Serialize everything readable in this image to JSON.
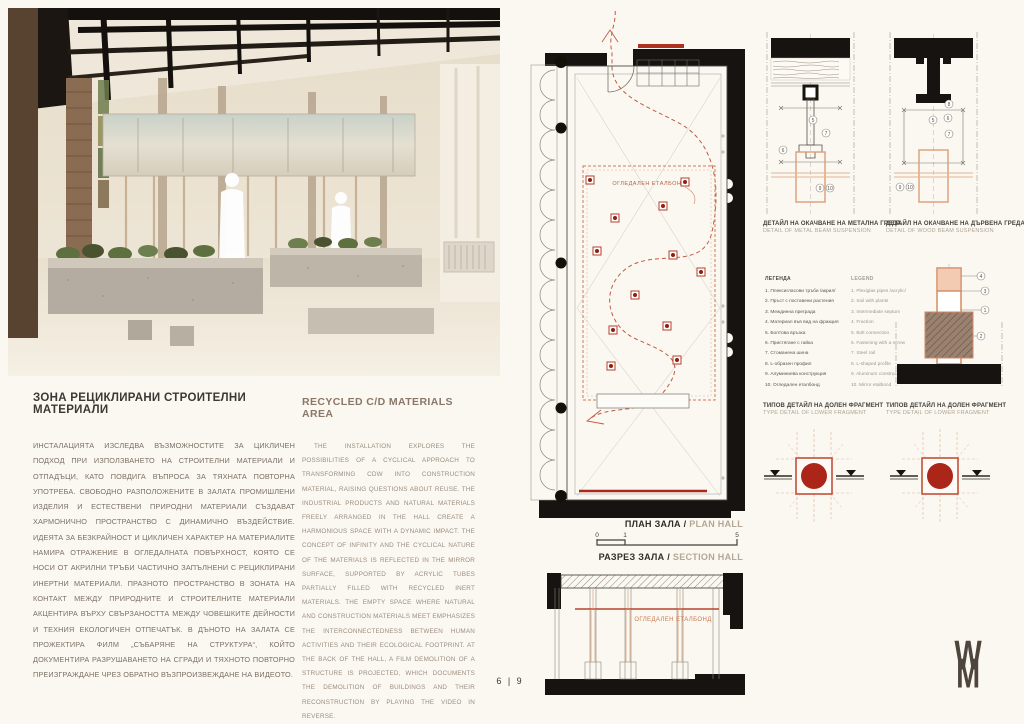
{
  "board": {
    "page_number": "6 | 9"
  },
  "colors": {
    "background": "#fbf8f2",
    "wall_black": "#171310",
    "accent_red": "#ab2619",
    "path_red": "#c25a43",
    "tube_orange": "#d6936c",
    "title_dark": "#3c3835",
    "title_brown": "#8a7767"
  },
  "left_text": {
    "bg_title": "ЗОНА РЕЦИКЛИРАНИ СТРОИТЕЛНИ МАТЕРИАЛИ",
    "bg_body": "ИНСТАЛАЦИЯТА ИЗСЛЕДВА ВЪЗМОЖНОСТИТЕ ЗА ЦИКЛИЧЕН ПОДХОД ПРИ ИЗПОЛЗВАНЕТО НА СТРОИТЕЛНИ МАТЕРИАЛИ И ОТПАДЪЦИ, КАТО ПОВДИГА ВЪПРОСА ЗА ТЯХНАТА ПОВТОРНА УПОТРЕБА. СВОБОДНО РАЗПОЛОЖЕНИТЕ В ЗАЛАТА ПРОМИШЛЕНИ ИЗДЕЛИЯ И ЕСТЕСТВЕНИ ПРИРОДНИ МАТЕРИАЛИ СЪЗДАВАТ ХАРМОНИЧНО ПРОСТРАНСТВО С ДИНАМИЧНО ВЪЗДЕЙСТВИЕ. ИДЕЯТА ЗА БЕЗКРАЙНОСТ И ЦИКЛИЧЕН ХАРАКТЕР НА МАТЕРИАЛИТЕ НАМИРА ОТРАЖЕНИЕ В ОГЛЕДАЛНАТА ПОВЪРХНОСТ, КОЯТО СЕ НОСИ ОТ АКРИЛНИ ТРЪБИ ЧАСТИЧНО ЗАПЪЛНЕНИ С РЕЦИКЛИРАНИ ИНЕРТНИ МАТЕРИАЛИ. ПРАЗНОТО ПРОСТРАНСТВО В ЗОНАТА НА КОНТАКТ МЕЖДУ ПРИРОДНИТЕ И СТРОИТЕЛНИТЕ МАТЕРИАЛИ АКЦЕНТИРА ВЪРХУ СВЪРЗАНОСТТА МЕЖДУ ЧОВЕШКИТЕ ДЕЙНОСТИ И ТЕХНИЯ ЕКОЛОГИЧЕН ОТПЕЧАТЪК. В ДЪНОТО НА ЗАЛАТА СЕ ПРОЖЕКТИРА ФИЛМ „СЪБАРЯНЕ НА СТРУКТУРА“, КОЙТО ДОКУМЕНТИРА РАЗРУШАВАНЕТО НА СГРАДИ И ТЯХНОТО ПОВТОРНО ПРЕИЗГРАЖДАНЕ ЧРЕЗ ОБРАТНО ВЪЗПРОИЗВЕЖДАНЕ НА ВИДЕОТО.",
    "en_title": "RECYCLED C/D MATERIALS AREA",
    "en_body": "THE INSTALLATION EXPLORES THE POSSIBILITIES OF A CYCLICAL APPROACH TO TRANSFORMING CDW INTO CONSTRUCTION MATERIAL, RAISING QUESTIONS ABOUT REUSE. THE INDUSTRIAL PRODUCTS AND NATURAL MATERIALS FREELY ARRANGED IN THE HALL CREATE A HARMONIOUS SPACE WITH A DYNAMIC IMPACT. THE CONCEPT OF INFINITY AND THE CYCLICAL NATURE OF THE MATERIALS IS REFLECTED IN THE MIRROR SURFACE, SUPPORTED BY ACRYLIC TUBES PARTIALLY FILLED WITH RECYCLED INERT MATERIALS. THE EMPTY SPACE WHERE NATURAL AND CONSTRUCTION MATERIALS MEET EMPHASIZES THE INTERCONNECTEDNESS BETWEEN HUMAN ACTIVITIES AND THEIR ECOLOGICAL FOOTPRINT. AT THE BACK OF THE HALL, A FILM DEMOLITION OF A STRUCTURE IS PROJECTED, WHICH DOCUMENTS THE DEMOLITION OF BUILDINGS AND THEIR RECONSTRUCTION BY PLAYING THE VIDEO IN REVERSE."
  },
  "plan": {
    "title_bg": "ПЛАН ЗАЛА",
    "sep": "/",
    "title_en": "PLAN HALL",
    "mirror_label": "ОГЛЕДАЛЕН ЕТАЛБОНД",
    "scale_ticks": [
      "0",
      "1",
      "5"
    ]
  },
  "section": {
    "title_bg": "РАЗРЕЗ ЗАЛА",
    "sep": "/",
    "title_en": "SECTION HALL",
    "mirror_label": "ОГЛЕДАЛЕН ЕТАЛБОНД"
  },
  "details": {
    "metal": {
      "title_bg": "ДЕТАЙЛ НА ОКАЧВАНЕ НА МЕТАЛНА ГРЕДА",
      "title_en": "DETAIL OF METAL BEAM SUSPENSION",
      "callouts": [
        "5",
        "6",
        "7",
        "9",
        "10"
      ]
    },
    "wood": {
      "title_bg": "ДЕТАЙЛ НА ОКАЧВАНЕ НА ДЪРВЕНА ГРЕДА",
      "title_en": "DETAIL OF WOOD BEAM SUSPENSION",
      "callouts": [
        "8",
        "5",
        "6",
        "7",
        "9",
        "10"
      ]
    },
    "base": {
      "callouts": [
        "4",
        "3",
        "1",
        "2"
      ]
    },
    "lower_left": {
      "title_bg": "ТИПОВ ДЕТАЙЛ НА ДОЛЕН ФРАГМЕНТ",
      "title_en": "TYPE DETAIL OF LOWER FRAGMENT"
    },
    "lower_right": {
      "title_bg": "ТИПОВ ДЕТАЙЛ НА ДОЛЕН ФРАГМЕНТ",
      "title_en": "TYPE DETAIL OF LOWER FRAGMENT"
    }
  },
  "legend_bg": {
    "title": "ЛЕГЕНДА",
    "items": [
      "1. Плексигласови тръби /акрил/",
      "2. Пръст с поставени растения",
      "3. Междинна преграда",
      "4. Материал във вид на фракция",
      "5. Болтова връзка",
      "6. Пристягане с гайка",
      "7. Стоманена шина",
      "8. L-образен профил",
      "9. Алуминиева конструкция",
      "10. Огледален еталбонд"
    ]
  },
  "legend_en": {
    "title": "LEGEND",
    "items": [
      "1. Plexiglas pipes /acrylic/",
      "2. Soil with plants",
      "3. Intermediate septum",
      "4. Fraction",
      "5. Bolt connection",
      "6. Fastening with a screw",
      "7. Steel rail",
      "8. L-shaped profile",
      "9. Aluminum construction",
      "10. Mirror etalbond"
    ]
  },
  "logo": {
    "top": "W",
    "bottom": "M"
  }
}
